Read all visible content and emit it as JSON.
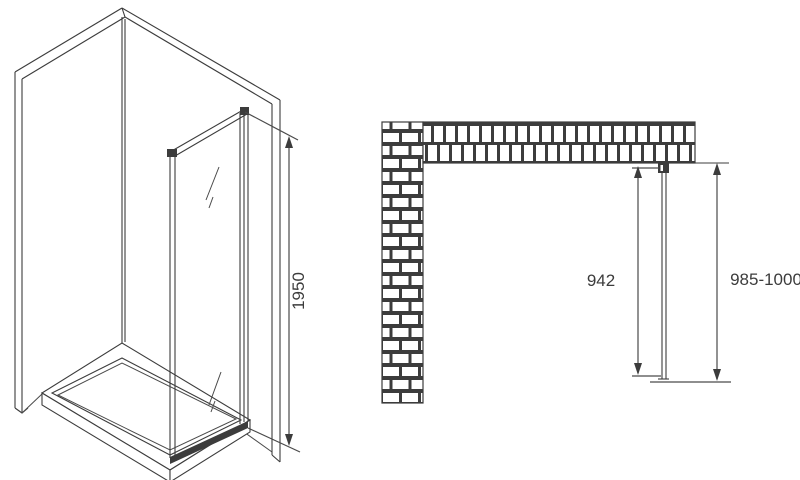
{
  "drawing": {
    "description": "Shower glass side panel dimension drawing",
    "left_view": {
      "name": "isometric-view",
      "height_label": "1950"
    },
    "plan_view": {
      "name": "plan-view",
      "glass_length_label": "942",
      "total_depth_label": "985-1000"
    },
    "colors": {
      "line": "#3c3c3c",
      "background": "#ffffff",
      "wall_joint": "#3c3c3c",
      "brick_fill": "#ffffff"
    }
  }
}
